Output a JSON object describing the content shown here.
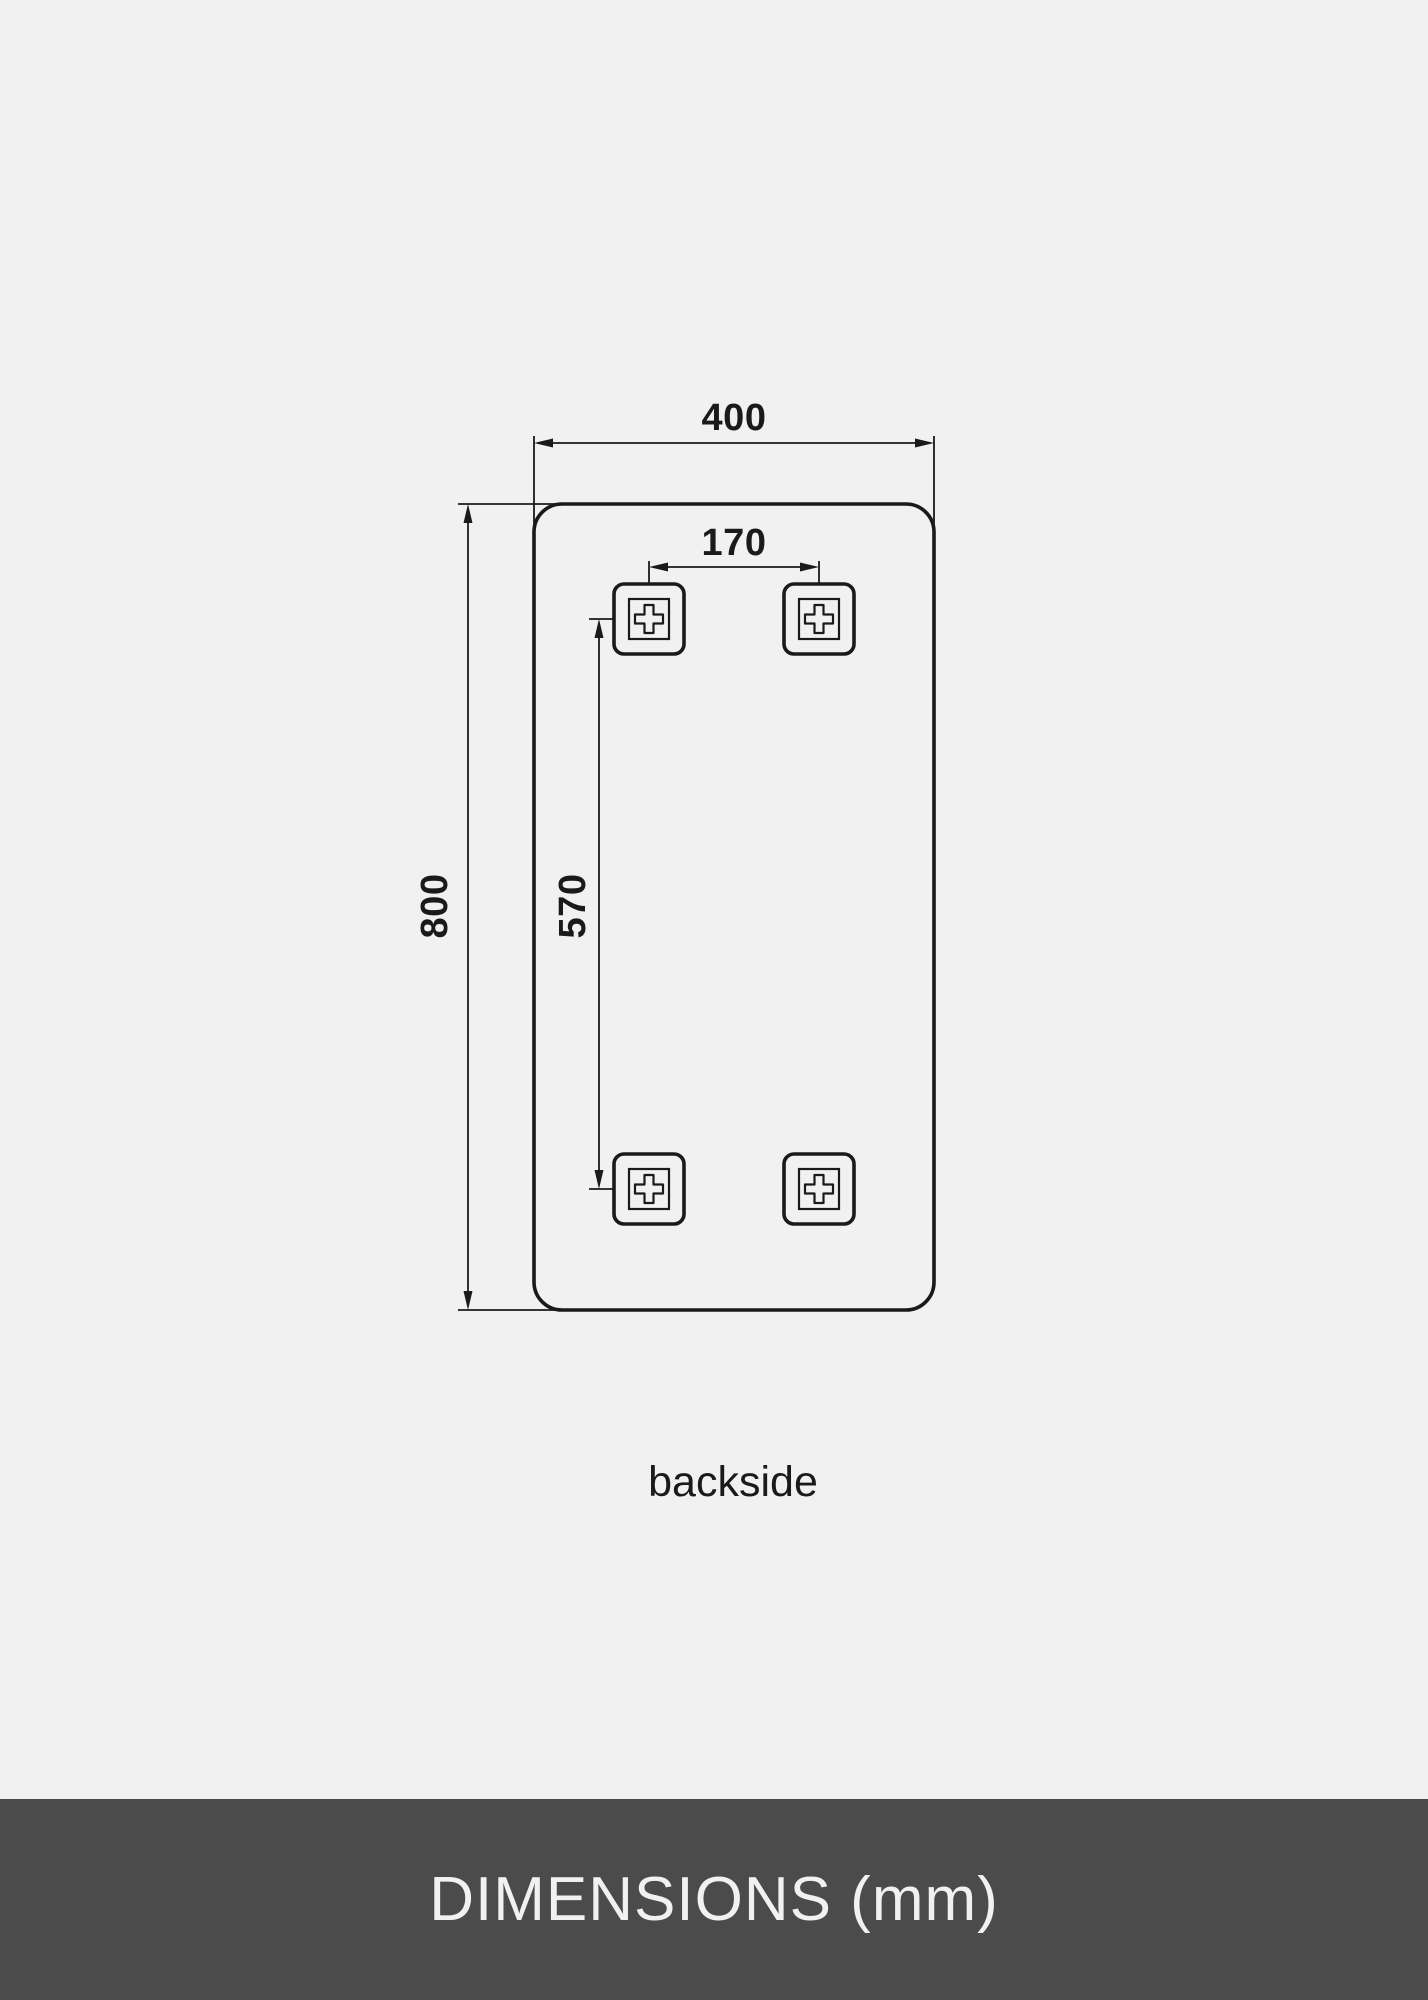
{
  "colors": {
    "background": "#f1f1f1",
    "line": "#1a1a1a",
    "footer_background": "#4b4b4b",
    "footer_text": "#f1f1f1"
  },
  "drawing": {
    "caption": "backside",
    "dimensions": {
      "overall_width": {
        "label": "400",
        "value_mm": 400
      },
      "overall_height": {
        "label": "800",
        "value_mm": 800
      },
      "bracket_horizontal_spacing": {
        "label": "170",
        "value_mm": 170
      },
      "bracket_vertical_spacing": {
        "label": "570",
        "value_mm": 570
      }
    },
    "bracket_count": 4
  },
  "footer": {
    "label": "DIMENSIONS (mm)"
  }
}
